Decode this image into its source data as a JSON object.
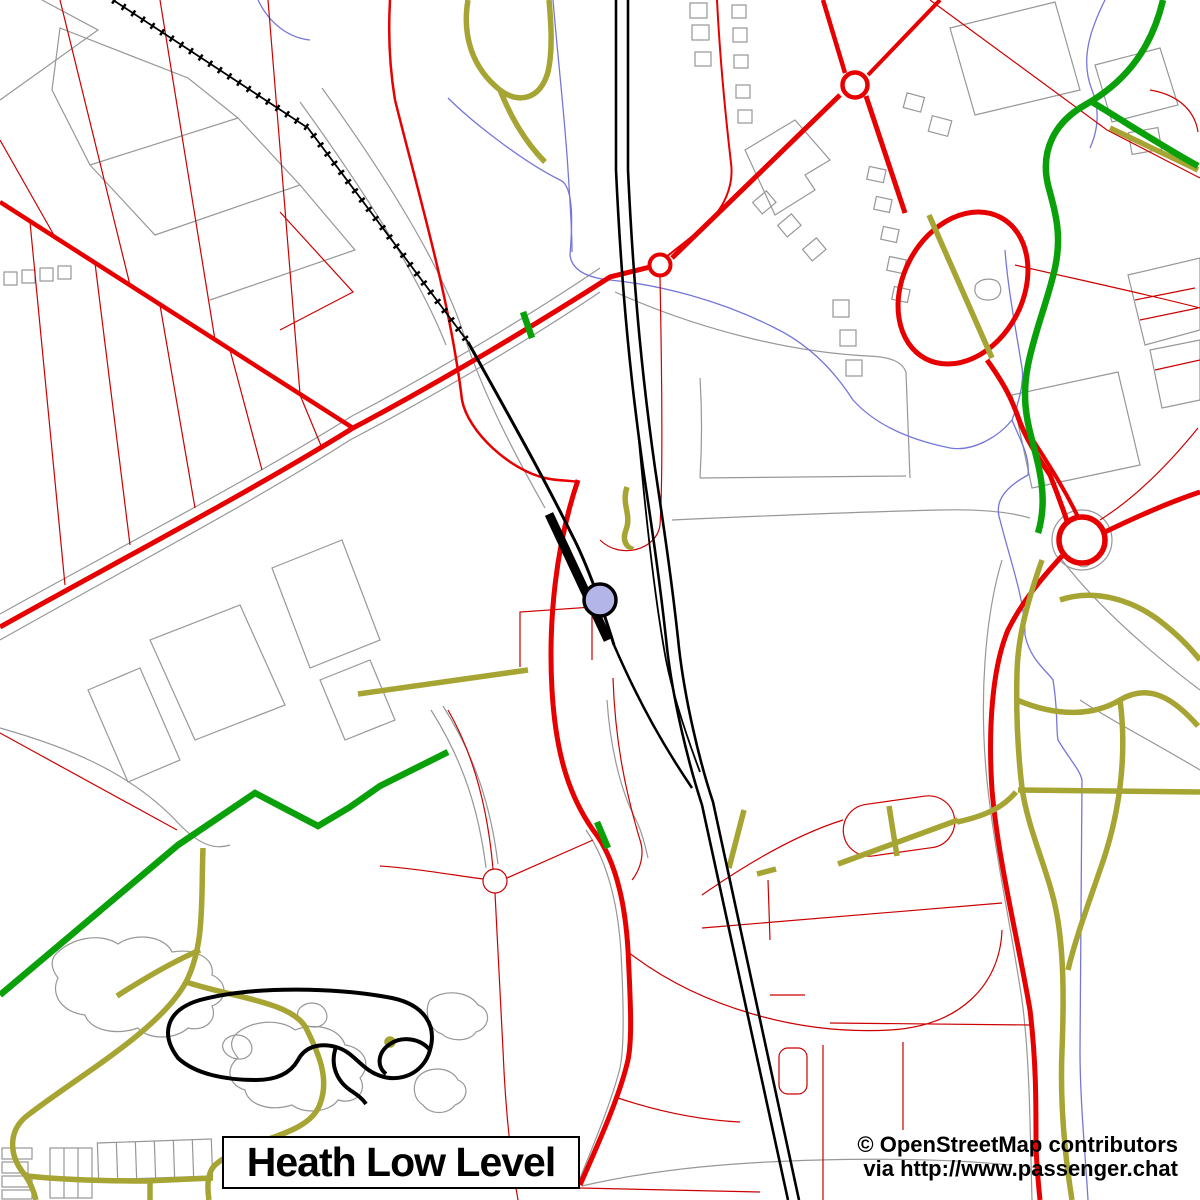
{
  "title_box": {
    "label": "Heath Low Level"
  },
  "attribution": {
    "line1": "© OpenStreetMap contributors",
    "line2": "via http://www.passenger.chat"
  },
  "colors": {
    "background": "#ffffff",
    "road_major": "#e60000",
    "road_minor": "#cc0000",
    "path_olive": "#a6a433",
    "path_green": "#0aa00a",
    "stream_blue": "#7577d8",
    "outline_gray": "#979797",
    "railway_black": "#000000",
    "station_marker_fill": "#b3b5e8",
    "text_black": "#000000"
  }
}
